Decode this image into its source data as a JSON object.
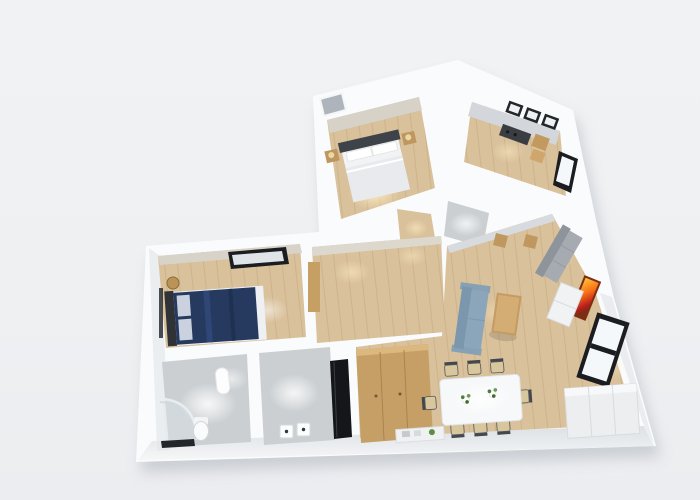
{
  "scene": {
    "title": "3D rendered apartment floor plan, top-down perspective view",
    "view": "top-down-3d-render",
    "visible_text": "none"
  },
  "palette": {
    "background": "#eff1f3",
    "wall": "#fafbfc",
    "wall-shade": "#dde1e6",
    "wall-face": "#d8dce1",
    "wood": "#d9c19b",
    "wood-light": "#ecd9b6",
    "tile": "#cbcfd2",
    "tile-light": "#e4e7e9",
    "furniture-wood": "#c49c63",
    "bed-navy": "#263a5f",
    "headboard": "#3e434a",
    "sofa-gray": "#a6abb1",
    "sofa-blue": "#8ba5ba",
    "art-orange": "#f97316",
    "frame-dark": "#1b1d20",
    "glass": "#f5f8fa",
    "plant": "#5c8f45",
    "glow-warm": "#ffedc4",
    "shadow": "#99a0a9"
  },
  "rooms": [
    {
      "id": "bedroom-main",
      "label": "Bedroom with double bed and nightstands"
    },
    {
      "id": "kitchen",
      "label": "Kitchen with cooktop counter and wall units"
    },
    {
      "id": "bedroom-blue",
      "label": "Bedroom with navy bed, glass partition and roof window"
    },
    {
      "id": "bathroom",
      "label": "Bathroom with curved glass shower and toilet"
    },
    {
      "id": "utility",
      "label": "Utility room with appliance column"
    },
    {
      "id": "hallway",
      "label": "Hallway"
    },
    {
      "id": "living-dining",
      "label": "Living and dining room with sofas, dining table for eight, orange wall art and windows"
    }
  ]
}
